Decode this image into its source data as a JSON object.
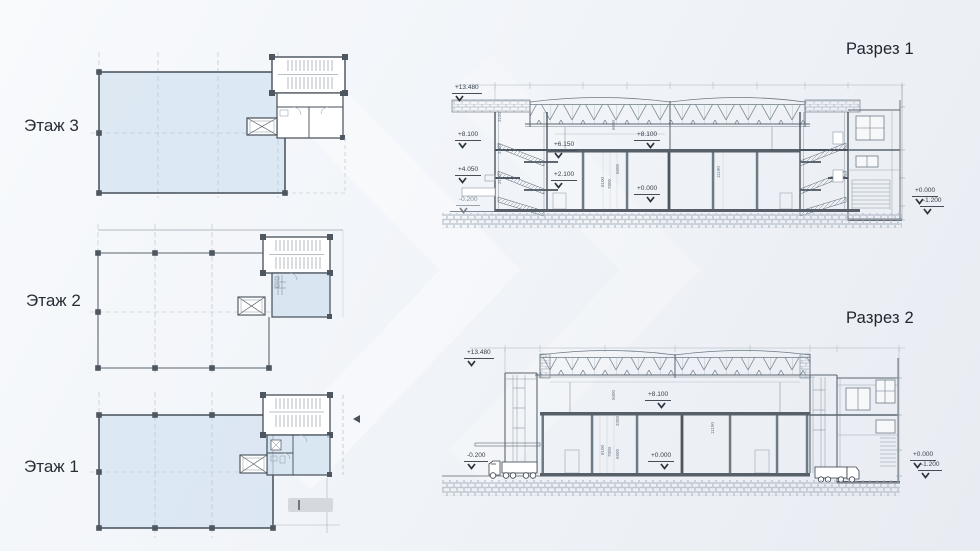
{
  "colors": {
    "background": "#eef1f6",
    "plan_fill": "#dce7f1",
    "line_dark": "#4a535d",
    "line_light": "#9aa6b1"
  },
  "floors": {
    "f3": {
      "label": "Этаж 3"
    },
    "f2": {
      "label": "Этаж 2"
    },
    "f1": {
      "label": "Этаж 1"
    }
  },
  "section1": {
    "title": "Разрез 1",
    "marks": {
      "left_top": "+13.480",
      "left_8100": "+8.100",
      "left_4050": "+4.050",
      "left_m0200": "-0.200",
      "stair_6150": "+6.150",
      "stair_2100": "+2.100",
      "mid_8100": "+8.100",
      "mid_0000": "+0.000",
      "right_0000": "+0.000",
      "right_m1200": "-1.200"
    },
    "dims": {
      "stair1": "3150",
      "stair2": "3150",
      "stair3": "3150",
      "roof": "6000",
      "h8100": "8100",
      "h7800": "7800",
      "h6600": "6600",
      "hall": "11190"
    }
  },
  "section2": {
    "title": "Разрез 2",
    "marks": {
      "left_top": "+13.480",
      "left_m0200": "-0.200",
      "mid_8100": "+8.100",
      "mid_0000": "+0.000",
      "right_0000": "+0.000",
      "right_m1200": "-1.200"
    },
    "dims": {
      "roof": "5000",
      "d3300": "3300",
      "h8100": "8100",
      "h7800": "7800",
      "h6600": "6600",
      "hall": "11190"
    }
  }
}
